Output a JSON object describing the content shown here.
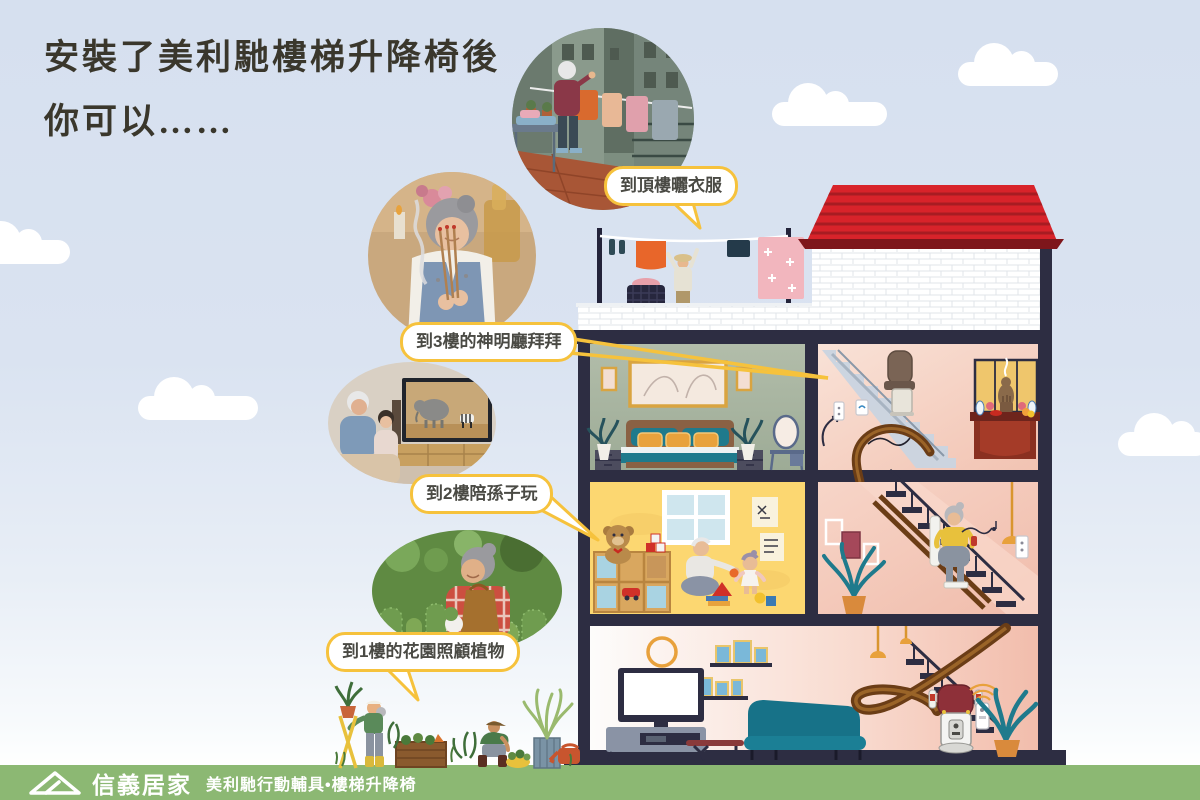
{
  "title": {
    "line1": "安裝了美利馳樓梯升降椅後",
    "line2": "你可以……"
  },
  "callouts": [
    {
      "label": "到頂樓曬衣服",
      "target": "rooftop-laundry"
    },
    {
      "label": "到3樓的神明廳拜拜",
      "target": "third-floor-shrine"
    },
    {
      "label": "到2樓陪孫子玩",
      "target": "second-floor-playroom"
    },
    {
      "label": "到1樓的花園照顧植物",
      "target": "first-floor-garden"
    }
  ],
  "photos": [
    {
      "scene": "elderly-woman-hanging-laundry-on-rooftop"
    },
    {
      "scene": "elderly-woman-offering-incense-at-altar"
    },
    {
      "scene": "grandfather-and-grandchild-watching-tv"
    },
    {
      "scene": "elderly-woman-tending-cactus-garden"
    }
  ],
  "footer": {
    "brand": "信義居家",
    "product": "美利馳行動輔具•樓梯升降椅"
  },
  "colors": {
    "sky": "#d6e0ef",
    "bubble_border": "#f6c23c",
    "roof_red": "#d8232a",
    "house_frame_navy": "#2d2d42",
    "bedroom_sage": "#a8b4a2",
    "shrine_pink": "#f6d8ca",
    "playroom_yellow": "#fcd771",
    "stairwell_pink": "#f3c6b8",
    "rail_brown": "#6b3d16",
    "sofa_teal": "#177288",
    "footer_green": "#8cb873"
  }
}
